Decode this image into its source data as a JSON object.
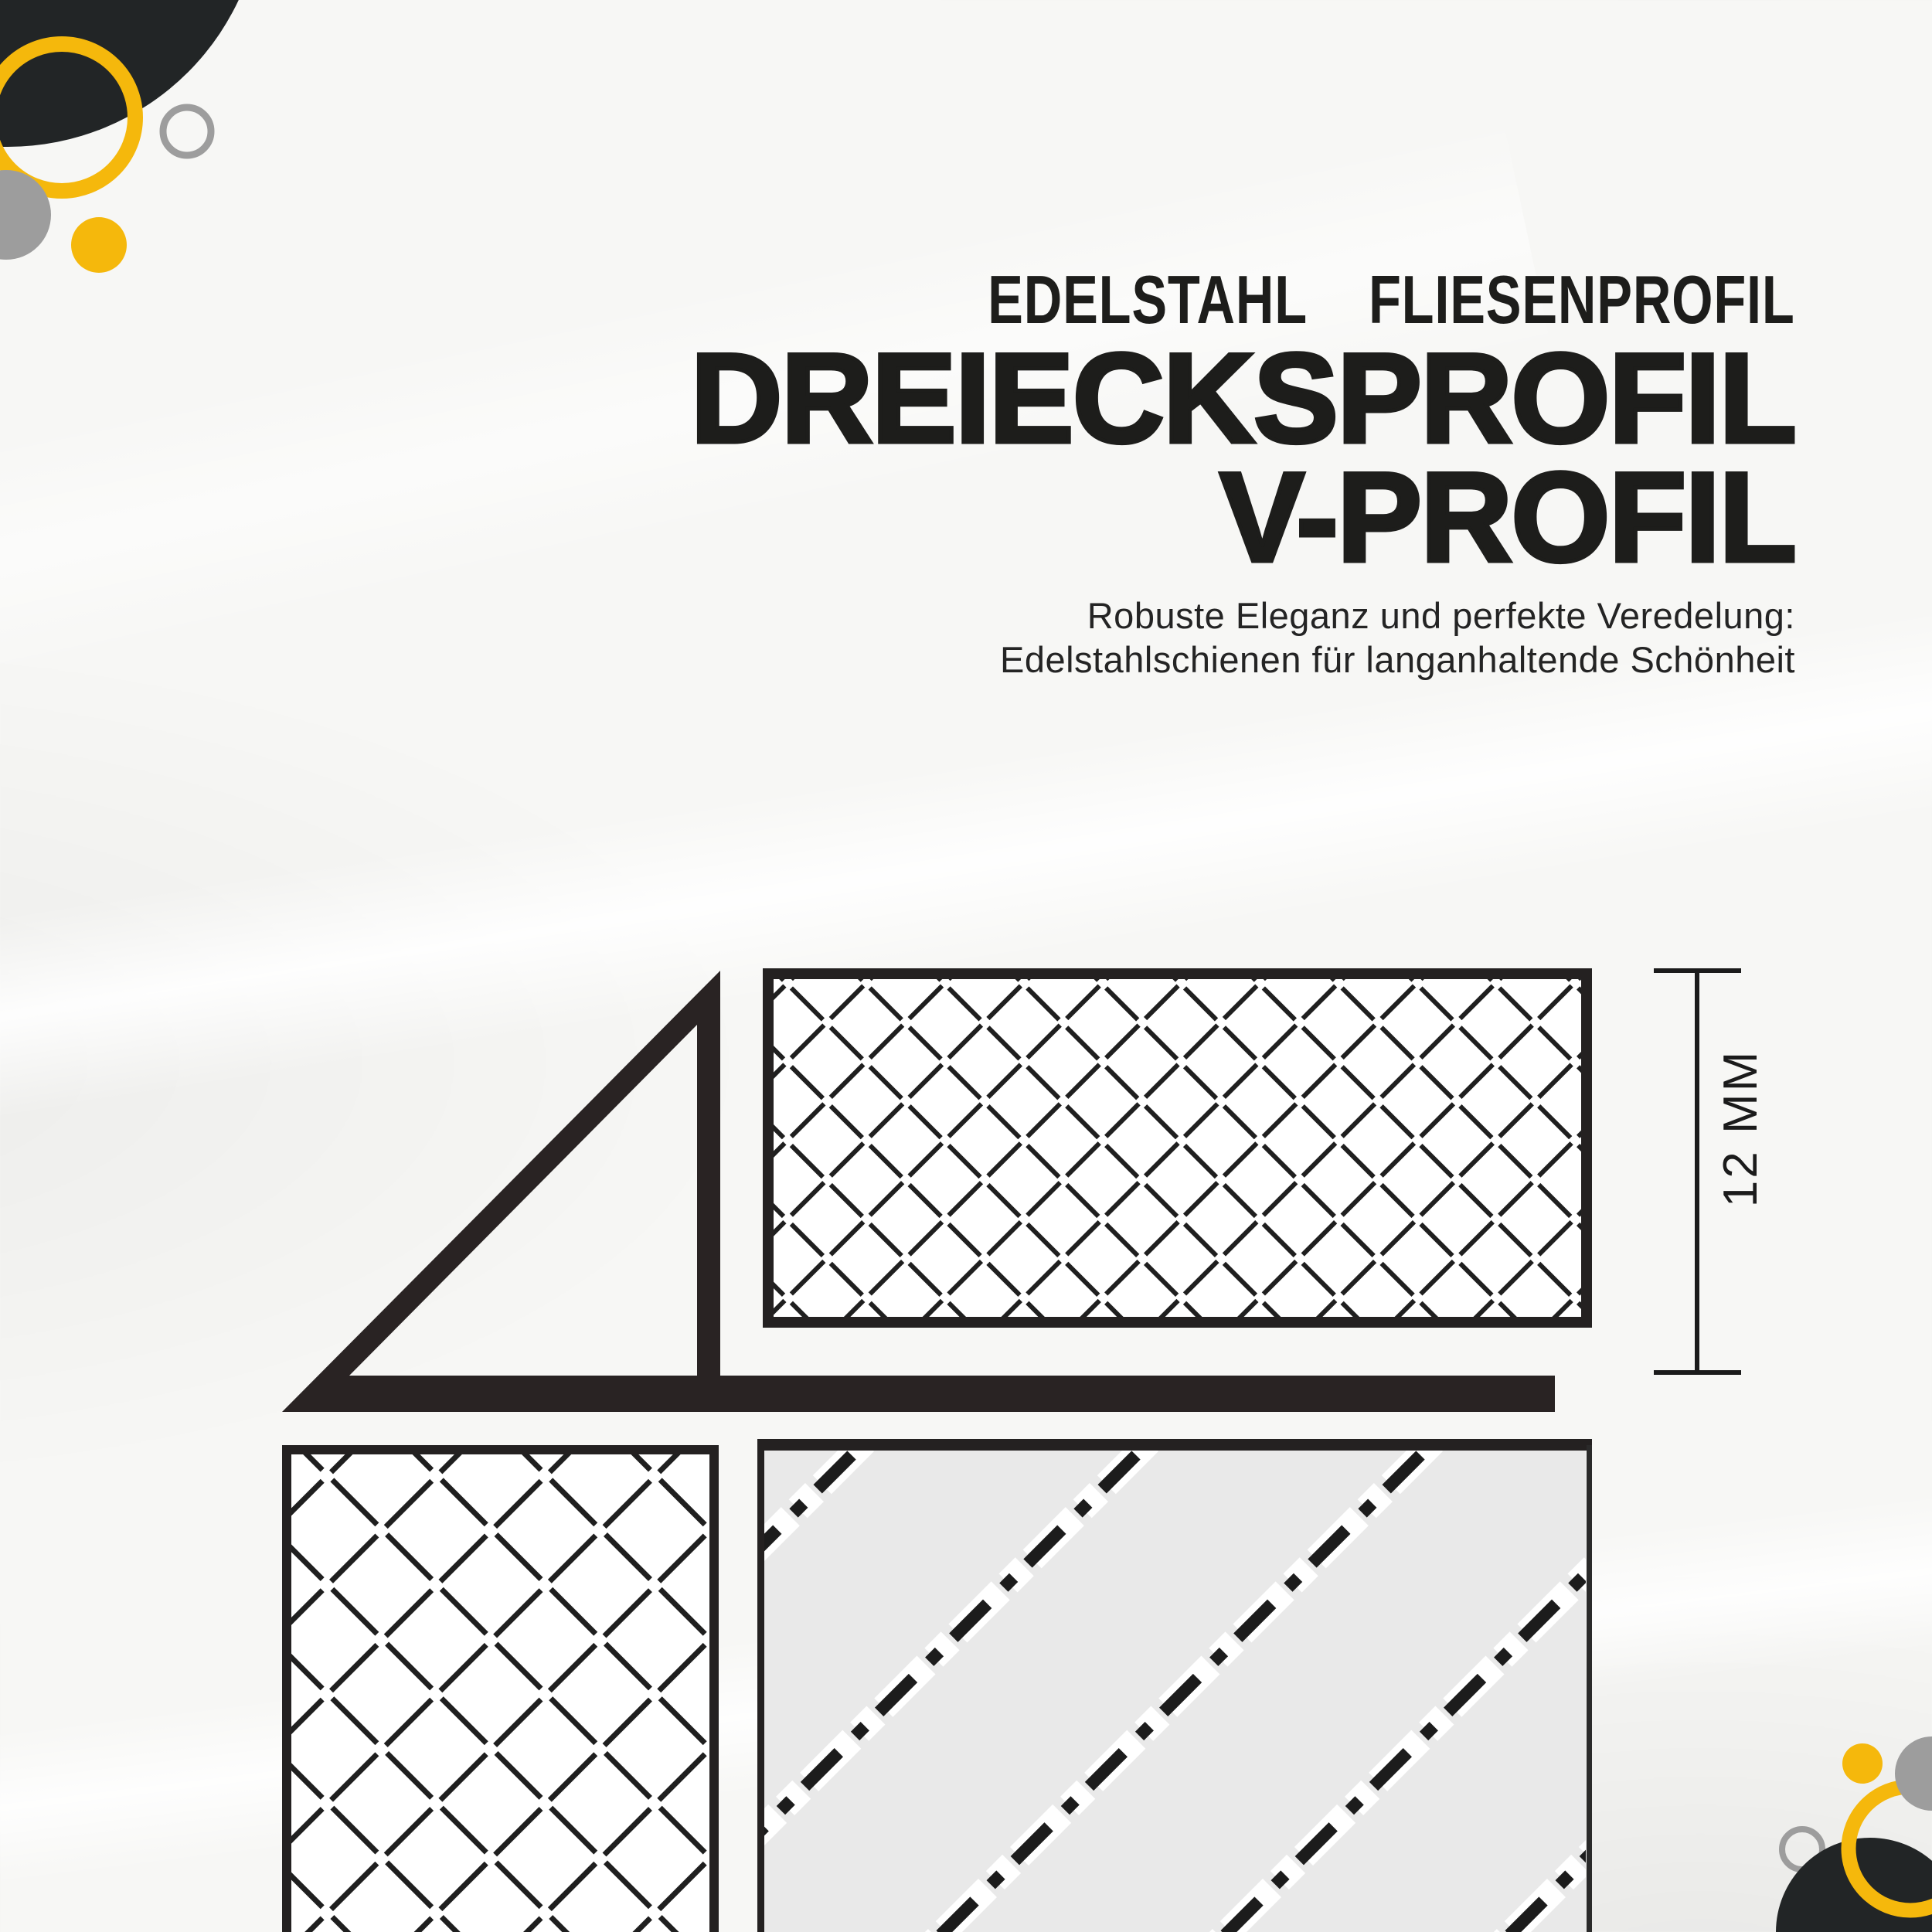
{
  "header": {
    "kicker": "EDELSTAHL  FLIESENPROFIL",
    "title_line1": "DREIECKSPROFIL",
    "title_line2": "V-PROFIL",
    "subtitle_line1": "Robuste Eleganz und perfekte Veredelung:",
    "subtitle_line2": "Edelstahlschienen für langanhaltende Schönheit"
  },
  "diagram": {
    "dimension_label": "12 MM",
    "parts": {
      "profile": "triangle-v-profile-rail",
      "tile_top": "hatched-tile-cross-section",
      "tile_left": "hatched-tile-cross-section",
      "substrate": "adhesive-substrate-section"
    }
  },
  "colors": {
    "ink": "#1d1d1b",
    "profile": "#292323",
    "box_border": "#242121",
    "hatch": "#1f1f1f",
    "substrate_fill": "#e9e9e9",
    "tile_fill": "#ffffff",
    "yellow": "#f5b80c",
    "gray": "#9d9d9d",
    "dark_blob": "#222526",
    "background": "#f7f7f5"
  }
}
